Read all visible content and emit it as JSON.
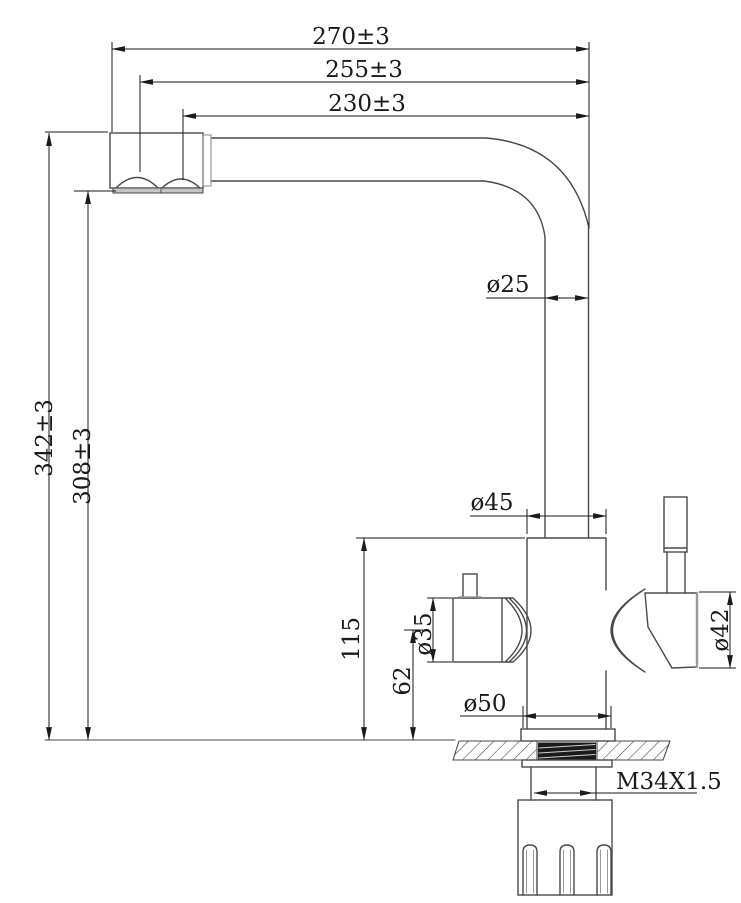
{
  "labels": {
    "overall_width": "270±3",
    "width_to_first_outlet": "255±3",
    "width_to_second_outlet": "230±3",
    "overall_height": "342±3",
    "spout_outlet_height": "308±3",
    "spout_tube_diameter": "ø25",
    "body_diameter": "ø45",
    "body_height": "115",
    "valve_axis_height": "62",
    "left_cartridge_diameter": "ø35",
    "right_cartridge_diameter": "ø42",
    "base_diameter": "ø50",
    "mounting_thread": "M34X1.5"
  },
  "colors": {
    "background": "#ffffff",
    "dimension": "#1a1a1a",
    "outline": "#4a4a4a",
    "outline_light": "#9a9a9a",
    "aerator_fill": "#c4c4c4",
    "hatch": "#3f3f3f",
    "thread_fill": "#1b1b1b",
    "thread_highlight": "#cfcfcf"
  }
}
